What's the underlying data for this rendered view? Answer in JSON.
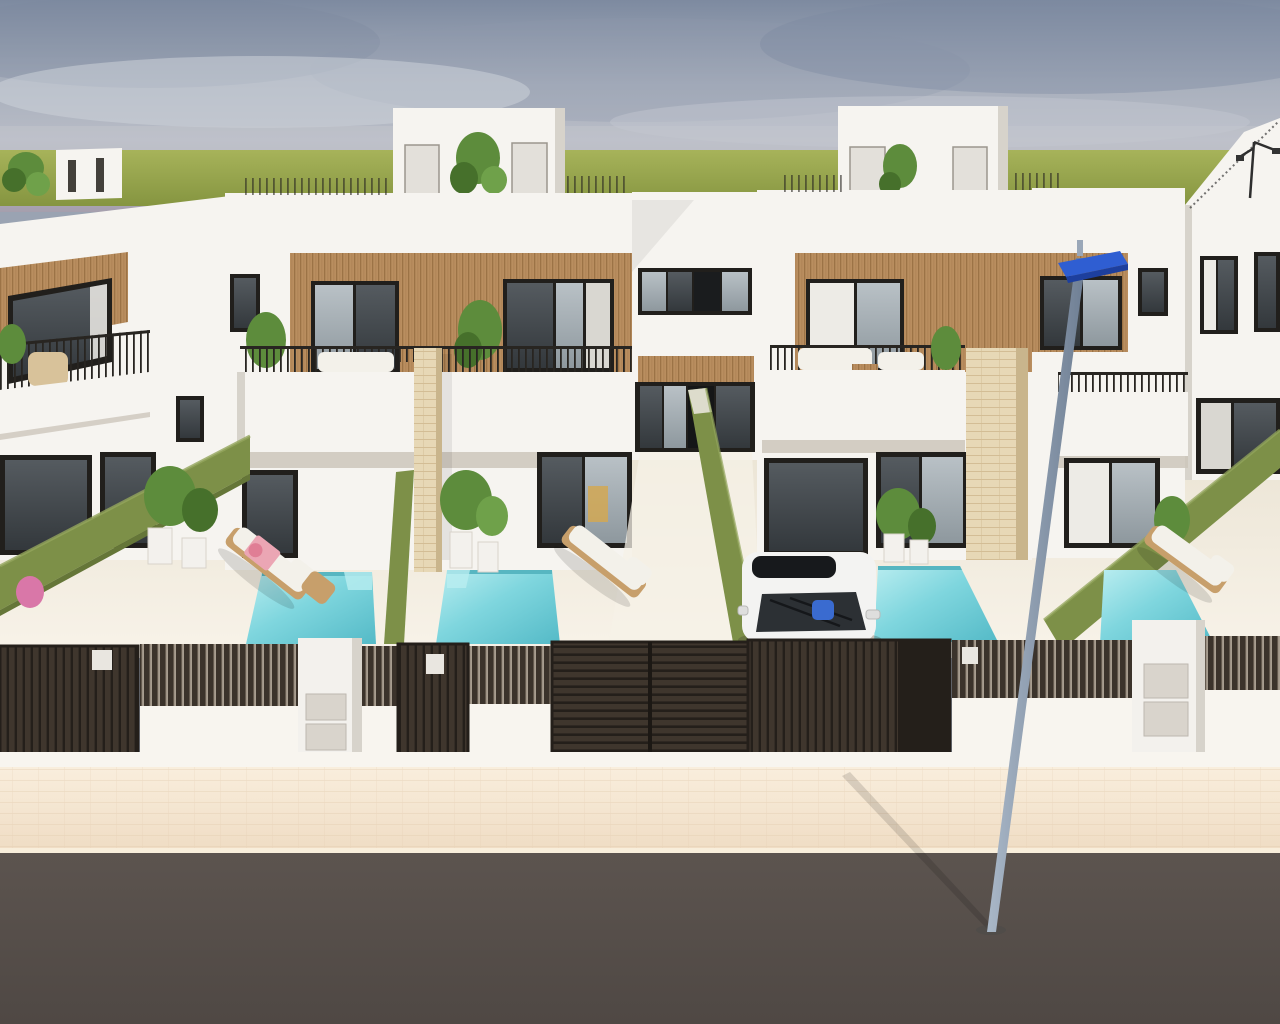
{
  "meta": {
    "kind": "architectural-3d-render",
    "canvas": {
      "width": 1280,
      "height": 1024
    }
  },
  "palette": {
    "sky_top": "#7d8aa0",
    "sky_mid": "#a9b0bd",
    "sky_low": "#b8bcc6",
    "sky_haze": "#a59fad",
    "cloud_dark": "#7b89a0",
    "cloud_light": "#ccd1d9",
    "field": "#a7b35a",
    "field_dark": "#859540",
    "wall": "#f6f4f0",
    "wall_shade": "#e8e5df",
    "wall_dark": "#d7d3cb",
    "soffit": "#cdc6bb",
    "wood": "#b98e5f",
    "wood_dark": "#976f42",
    "frame": "#211f1c",
    "glass_dark": "#33383c",
    "glass_light": "#a8b2b8",
    "curtain": "#edebe6",
    "railing": "#282521",
    "hedge": "#7d9048",
    "hedge_dark": "#657638",
    "hedge_light": "#c3cba6",
    "pool_light": "#b9edf0",
    "pool": "#7fd6de",
    "pool_dark": "#54bac7",
    "terrace": "#eae3d3",
    "terrace_light": "#f8f3e9",
    "stone": "#e7d8b6",
    "stone_line": "#d3bd95",
    "fence": "#3b332b",
    "fence_dark": "#241f1a",
    "fence_gap": "#a79d8f",
    "base_wall": "#f8f5ef",
    "mailbox": "#f3f1ed",
    "mailbox_panel": "#d9d4cc",
    "sidewalk": "#efdcc3",
    "sidewalk_light": "#f9eedd",
    "road": "#5c544f",
    "road_dark": "#4f4844",
    "car_white": "#f3f3f2",
    "car_glass": "#2c3034",
    "car_roof": "#17191c",
    "car_bag": "#3a6bd0",
    "lamp_pole": "#aab8c8",
    "lamp_pole_dark": "#6e7e93",
    "lamp_head": "#2f5ed2",
    "lounger_wood": "#c79f6b",
    "cushion": "#f3f1ea",
    "towel": "#eba6b4",
    "towel_dark": "#e07e95",
    "plant": "#5d8c3c",
    "plant_dark": "#46702b",
    "shadow": "#3c3732"
  },
  "scene": {
    "labels": {
      "stage": "street elevation render of new-build terraced villas with pools",
      "sky": "hazy sky with soft clouds",
      "field": "green field at the horizon",
      "terrace": "cream terrace floor of the front yards",
      "house_left": "left house partially visible",
      "house_a": "centre-left villa with wood cladding and balcony",
      "connector": "central entrance passage between villas",
      "house_b": "centre-right villa with wood cladding and balcony",
      "house_c": "right villa partially visible",
      "rooftop_room": "white rooftop stair room",
      "pool": "turquoise plunge pool",
      "lounger": "wooden sun lounger with white cushion",
      "planters": "potted plants in white planters",
      "hedge": "green hedge plot divider",
      "car": "white car parked on the driveway",
      "fence": "dark slatted street fence on white base wall",
      "gate": "dark slatted gate",
      "mailbox_pillar": "white letterbox pillar",
      "street_lamp": "street lamp with blue head",
      "sidewalk": "beige paved sidewalk",
      "road": "asphalt road"
    },
    "counts": {
      "houses_visible": 5,
      "rooftop_rooms": 3,
      "pools_visible": 4,
      "sun_loungers": 3,
      "cars": 1,
      "street_lamps": 2,
      "gates": 4,
      "letterbox_pillars": 2
    }
  }
}
